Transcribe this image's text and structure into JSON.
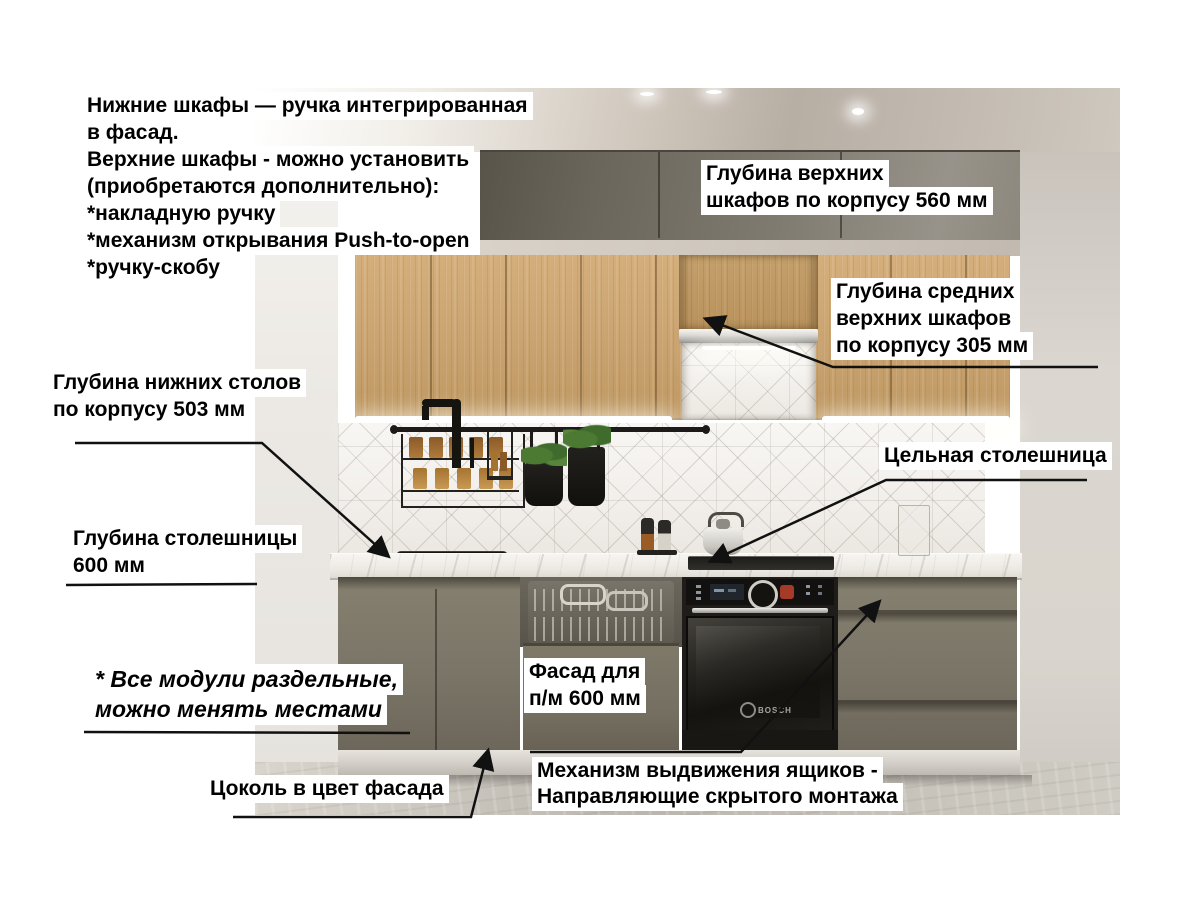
{
  "annotations": {
    "info_block": "Нижние шкафы — ручка интегрированная\nв фасад.\nВерхние шкафы - можно установить\n(приобретаются дополнительно):\n*накладную ручку\n*механизм открывания Push-to-open\n*ручку-скобу",
    "upper_cabinet_depth": "Глубина верхних\nшкафов по корпусу 560 мм",
    "middle_upper_cabinet_depth": "Глубина средних\nверхних шкафов\nпо корпусу 305 мм",
    "base_cabinet_depth": "Глубина нижних столов\nпо корпусу 503 мм",
    "solid_countertop": "Цельная столешница",
    "countertop_depth": "Глубина столешницы\n600 мм",
    "modules_note": "* Все модули раздельные,\nможно менять местами",
    "dishwasher_facade": "Фасад для\nп/м 600 мм",
    "plinth_note": "Цоколь в цвет фасада",
    "drawer_mechanism": "Механизм выдвижения ящиков -\nНаправляющие скрытого монтажа"
  },
  "scene": {
    "oven_brand": "BOSCH"
  },
  "colors": {
    "annotation_text": "#000000",
    "annotation_bg": "#ffffff",
    "arrow": "#111111",
    "facade_gray": "#7a7567",
    "upper_cabinet_gray": "#7c776d",
    "wood": "#c9a370",
    "countertop": "#f0ede8",
    "tile": "#f4f2ee",
    "wall": "#dedad3",
    "floor": "#bfbbb3",
    "appliance_black": "#1b1a17"
  }
}
